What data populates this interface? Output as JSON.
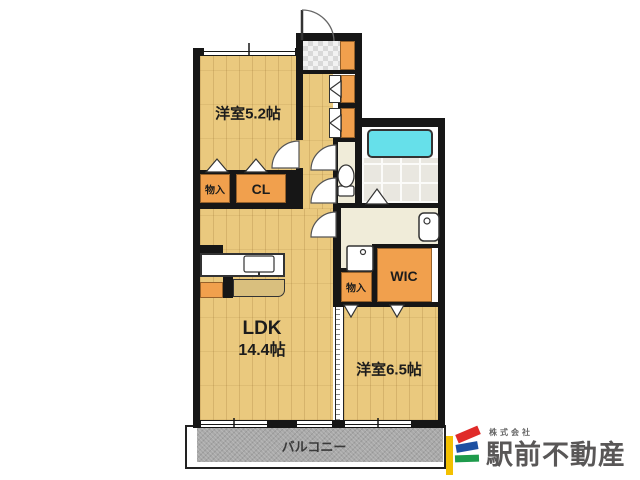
{
  "floorplan": {
    "rooms": {
      "bedroom_52": "洋室5.2帖",
      "bedroom_65": "洋室6.5帖",
      "ldk_name": "LDK",
      "ldk_size": "14.4帖",
      "closet": "CL",
      "storage_upper": "物入",
      "storage_lower": "物入",
      "wic": "WIC",
      "balcony": "バルコニー"
    },
    "colors": {
      "wood_floor": "#eac97e",
      "closet_orange": "#f1a04d",
      "bathtub_cyan": "#66e0ea",
      "balcony_gray": "#a9a9a9",
      "wall_black": "#161616",
      "washroom_cream": "#f0ecd9"
    }
  },
  "logo": {
    "prefix": "株式会社",
    "name": "駅前不動産",
    "text_color": "#595757",
    "mark_colors": {
      "yellow": "#f3c000",
      "red": "#e02b29",
      "blue": "#1d50a2",
      "green": "#1e9b4c"
    }
  }
}
